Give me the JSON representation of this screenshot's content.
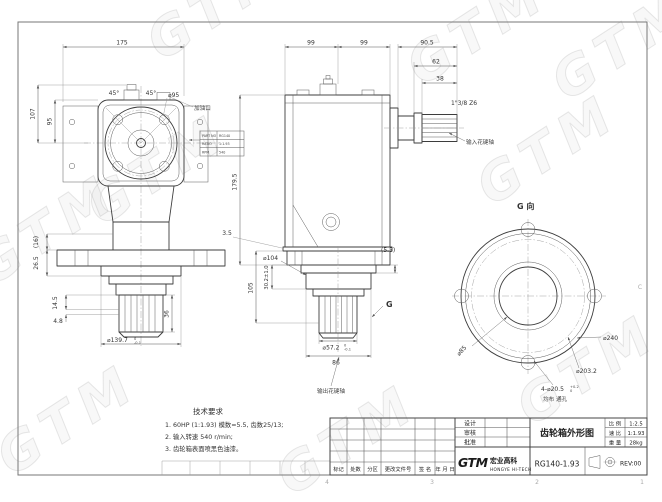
{
  "watermark": "GTM",
  "frame": {
    "zone_numbers": [
      "4",
      "3",
      "2",
      "1"
    ],
    "fold_mark": "C"
  },
  "tech_req": {
    "heading": "技术要求",
    "items": [
      "1. 60HP (1:1.93)  模数=5.5, 齿数25/13;",
      "2. 输入转速 540 r/min;",
      "3. 齿轮箱表面喷黑色油漆。"
    ]
  },
  "front_view": {
    "dim_width": "175",
    "angle_left": "45°",
    "angle_right": "45°",
    "bolt_circle": "⌀95",
    "dim_h_outer": "107",
    "dim_h_inner": "95",
    "oil_port_label": "加油口",
    "dim_ref16": "(16)",
    "dim_26_5": "26.5",
    "dim_14_5": "14.5",
    "dim_4_8": "4.8",
    "spigot_dia": "⌀139.7",
    "spigot_tol_top": "0",
    "spigot_tol_bot": "-0.1",
    "dim_36": "36"
  },
  "nameplate": {
    "rows": [
      {
        "k": "PART NO",
        "v": "RG140"
      },
      {
        "k": "RATIO",
        "v": "1:1.93"
      },
      {
        "k": "RPM",
        "v": "540"
      }
    ]
  },
  "side_view": {
    "dim_99a": "99",
    "dim_99b": "99",
    "dim_90_5": "90.5",
    "dim_62": "62",
    "dim_38": "38",
    "spline_spec": "1\"3/8 Z6",
    "input_label": "输入花键轴",
    "dim_179_5": "179.5",
    "dim_3_5": "3.5",
    "dim_5_5": "(5.5)",
    "hub_dia": "⌀104",
    "dim_30_2": "30.2±1.0",
    "dim_105": "105",
    "out_dia": "⌀57.2",
    "out_tol_top": "0",
    "out_tol_bot": "-0.1",
    "dim_86": "86",
    "g_mark": "G",
    "output_label": "输出花键轴"
  },
  "g_view": {
    "title": "G 向",
    "outer_dia": "⌀240",
    "bolt_circle": "⌀203.2",
    "holes": "4-⌀20.5",
    "holes_tol_top": "+0.2",
    "holes_tol_bot": "0",
    "holes_note": "均布  通孔",
    "bore_dia": "⌀85"
  },
  "title_block": {
    "sign_rows": [
      "设计",
      "审核",
      "批准"
    ],
    "title": "齿轮箱外形图",
    "info": [
      {
        "label": "比 例",
        "value": "1:2.5"
      },
      {
        "label": "速 比",
        "value": "1:1.93"
      },
      {
        "label": "重 量",
        "value": "28kg"
      }
    ],
    "logo_text": "GTM",
    "company_cn": "宏业高科",
    "company_en": "HONGYE HI-TECH",
    "part_no": "RG140-1.93",
    "rev": "REV:00",
    "change_cols": [
      "标记",
      "处数",
      "分区",
      "更改文件号",
      "签 名",
      "年 月 日"
    ]
  }
}
